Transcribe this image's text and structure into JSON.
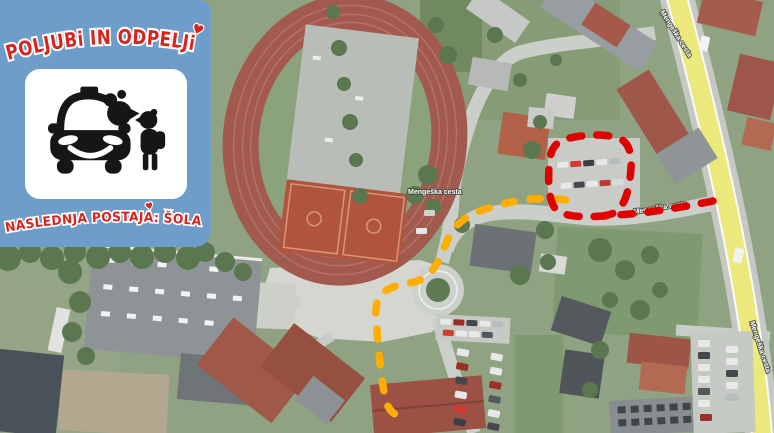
{
  "panel": {
    "title": "POLJUBi IN ODPELJi",
    "caption": "NASLEDNJA POSTAJA: ŠOLA",
    "heart_icon": "♥",
    "icon": "kiss-and-ride-parent-kissing-child-at-car",
    "colors": {
      "background": "#6D9DC8",
      "lettering_red": "#D7251D",
      "lettering_outline": "#FFFFFF",
      "card_background": "#FFFFFF",
      "icon_black": "#161616"
    }
  },
  "map": {
    "type": "aerial-photo",
    "street_labels": [
      {
        "text": "Mengeška cesta",
        "position": "center"
      },
      {
        "text": "Mengeška cesta",
        "position": "top-right-road"
      },
      {
        "text": "Mengeška cesta",
        "position": "right-edge-road"
      },
      {
        "text": "Mengeška cesta",
        "position": "near-dropoff-loop"
      }
    ],
    "overlays": {
      "dropoff_loop": {
        "color": "#E00000",
        "style": "dashed"
      },
      "approach_route": {
        "color": "#FFAD00",
        "style": "dashed"
      }
    }
  }
}
